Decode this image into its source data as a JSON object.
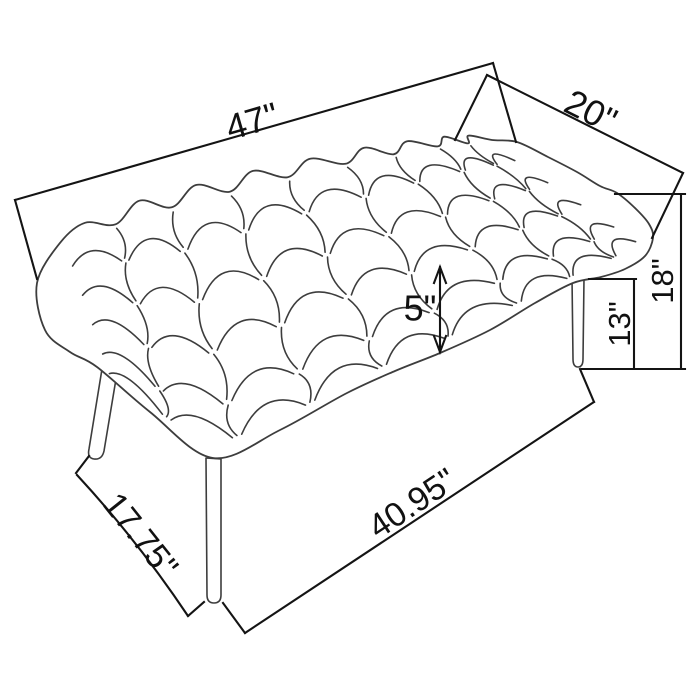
{
  "page": {
    "background": "#ffffff"
  },
  "drawing": {
    "subject": "Tufted upholstered bench with angled legs - dimension line drawing",
    "style": "hand-drawn perspective product sketch",
    "line_color": "#3d3d3d",
    "dimension_color": "#141414",
    "label_color": "#111111"
  },
  "dims": {
    "length": "47\"",
    "depth": "20\"",
    "height": "18\"",
    "seat_clearance": "13\"",
    "cushion_thickness": "5\"",
    "leg_span_depth": "17.75\"",
    "leg_span_length": "40.95\""
  }
}
